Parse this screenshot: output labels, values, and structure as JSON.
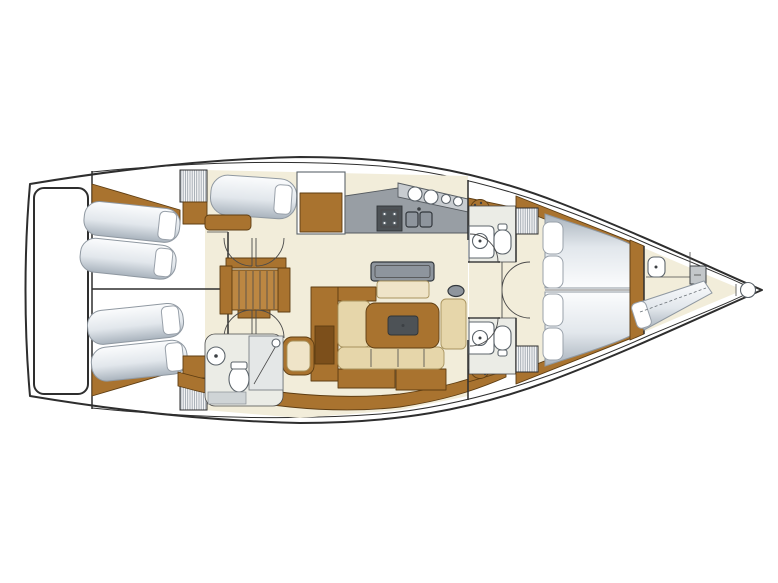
{
  "diagram": {
    "type": "sailing-yacht-interior-floor-plan",
    "orientation": "bow-right-top-view",
    "features": [
      "swim-platform",
      "aft-cabin-port-twin-berths",
      "aft-cabin-starboard-twin-berths",
      "hanging-wardrobes",
      "companionway-stairs",
      "single-berth-cabin-port",
      "galley-counter-stove-double-sink-burners",
      "saloon-u-shaped-sofa",
      "saloon-table",
      "sideboard-bench",
      "chart-seat-and-cabinet",
      "day-head-with-shower-toilet-round-sink",
      "port-vanity-stool",
      "starboard-vanity-stool",
      "owner-cabin-v-berth",
      "port-head-toilet-sink",
      "starboard-head-toilet-sink",
      "forepeak-crew-berth-with-sink-and-locker",
      "bow-anchor-fitting"
    ]
  },
  "colors": {
    "hull_outline": "#2e2e2e",
    "line": "#4a4a4a",
    "white": "#ffffff",
    "wood": "#a9732f",
    "wood_light": "#bc8742",
    "wood_dark": "#7c4f1b",
    "wood_edge": "#5e3d12",
    "floor": "#f2edda",
    "floor_head": "#ebece6",
    "cushion": "#e6d6aa",
    "cushion_light": "#efe4c8",
    "mattress_hi": "#fbfcfd",
    "mattress_mid": "#e2e7ec",
    "mattress_lo": "#a9b3bd",
    "counter": "#989ea4",
    "counter_light": "#c8ccd0",
    "appliance": "#4d5256",
    "steel": "#8e959d",
    "stripe": "#9aa2ab"
  }
}
